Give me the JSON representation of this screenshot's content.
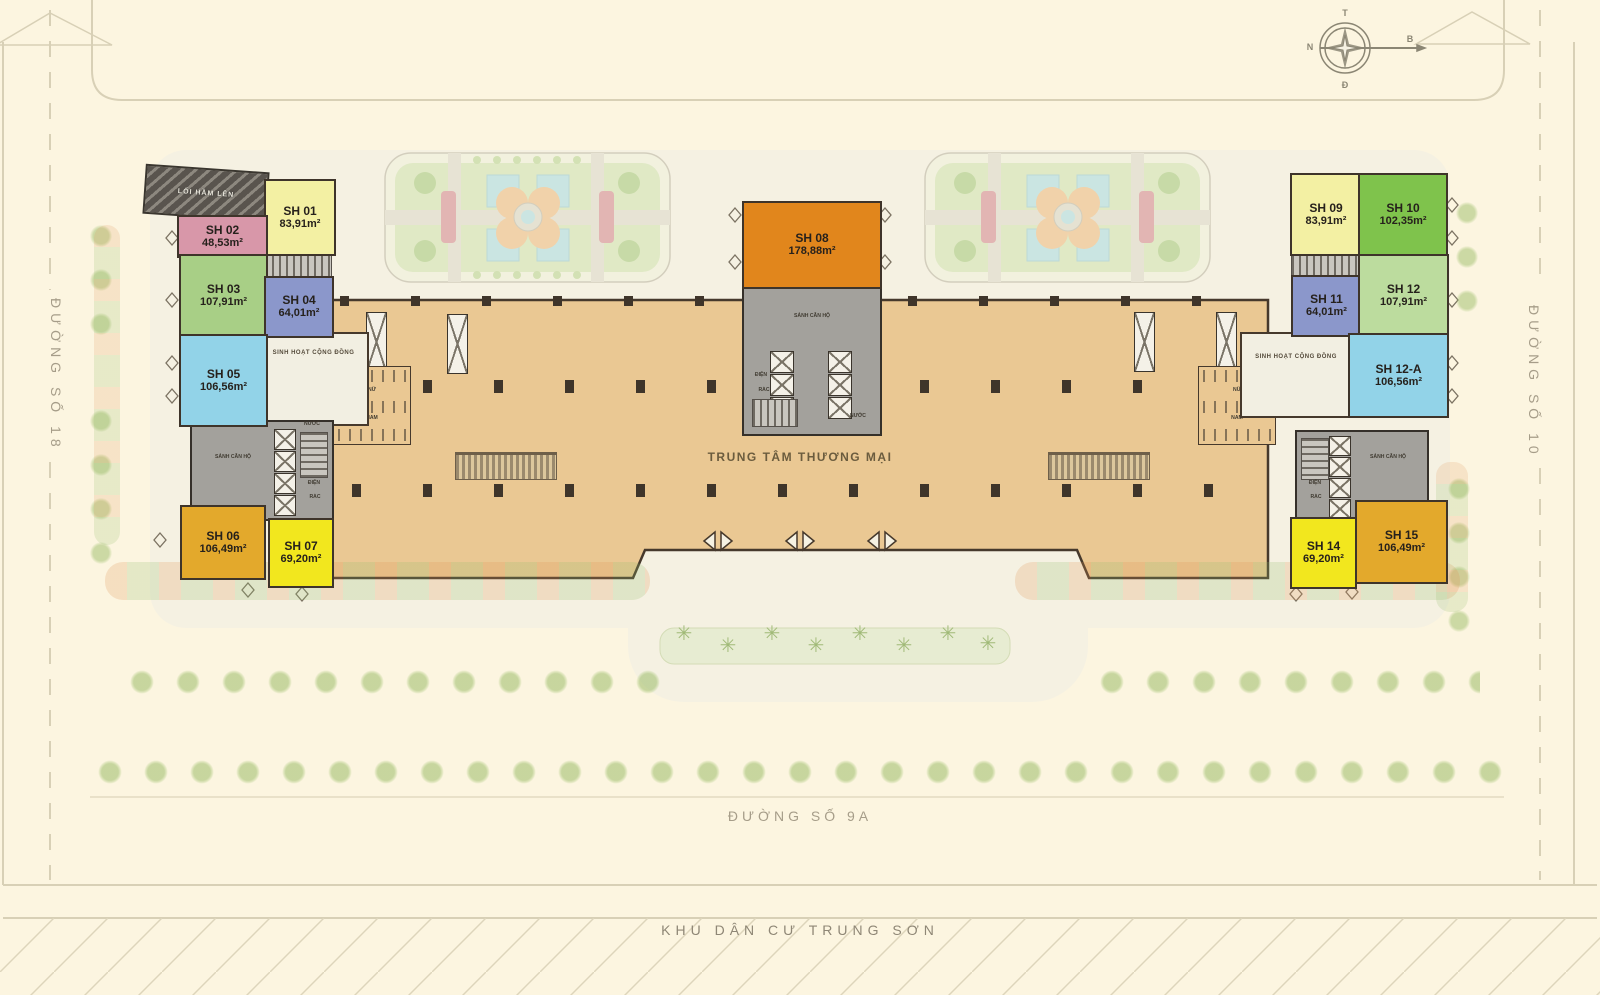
{
  "streets": {
    "left": "ĐƯỜNG SỐ 18",
    "right": "ĐƯỜNG SỐ 10",
    "bottom": "ĐƯỜNG SỐ 9A",
    "residential_area": "KHU DÂN CƯ TRUNG SƠN"
  },
  "compass": {
    "top": "T",
    "left": "N",
    "bottom": "Đ",
    "right": "B"
  },
  "areas": {
    "mall": "TRUNG TÂM THƯƠNG MẠI",
    "lobby": "SẢNH CĂN HỘ",
    "community": "SINH HOẠT CỘNG ĐỒNG",
    "ramp": "LỐI HẦM LÊN",
    "water": "NƯỚC",
    "electricity": "ĐIỆN",
    "trash": "RÁC",
    "wc_female": "NỮ",
    "wc_male": "NAM"
  },
  "units": [
    {
      "id": "SH 01",
      "area": "83,91m²",
      "color": "#f3f0a3"
    },
    {
      "id": "SH 02",
      "area": "48,53m²",
      "color": "#d897a9"
    },
    {
      "id": "SH 03",
      "area": "107,91m²",
      "color": "#a8cf86"
    },
    {
      "id": "SH 04",
      "area": "64,01m²",
      "color": "#8b97cb"
    },
    {
      "id": "SH 05",
      "area": "106,56m²",
      "color": "#92d3e8"
    },
    {
      "id": "SH 06",
      "area": "106,49m²",
      "color": "#e3a92c"
    },
    {
      "id": "SH 07",
      "area": "69,20m²",
      "color": "#f2e71e"
    },
    {
      "id": "SH 08",
      "area": "178,88m²",
      "color": "#e1861c"
    },
    {
      "id": "SH 09",
      "area": "83,91m²",
      "color": "#f3f0a3"
    },
    {
      "id": "SH 10",
      "area": "102,35m²",
      "color": "#7fc34c"
    },
    {
      "id": "SH 11",
      "area": "64,01m²",
      "color": "#8b97cb"
    },
    {
      "id": "SH 12",
      "area": "107,91m²",
      "color": "#bcdc9e"
    },
    {
      "id": "SH 12-A",
      "area": "106,56m²",
      "color": "#92d3e8"
    },
    {
      "id": "SH 14",
      "area": "69,20m²",
      "color": "#f2e71e"
    },
    {
      "id": "SH 15",
      "area": "106,49m²",
      "color": "#e3a92c"
    }
  ],
  "palette": {
    "background": "#fcf5e0",
    "mall_floor": "#eac893",
    "core_gray": "#a3a19c",
    "walkway": "#f5f1e2",
    "road_line": "#d8d0b6",
    "wall_line": "#46392c",
    "street_text": "#a69d89"
  }
}
